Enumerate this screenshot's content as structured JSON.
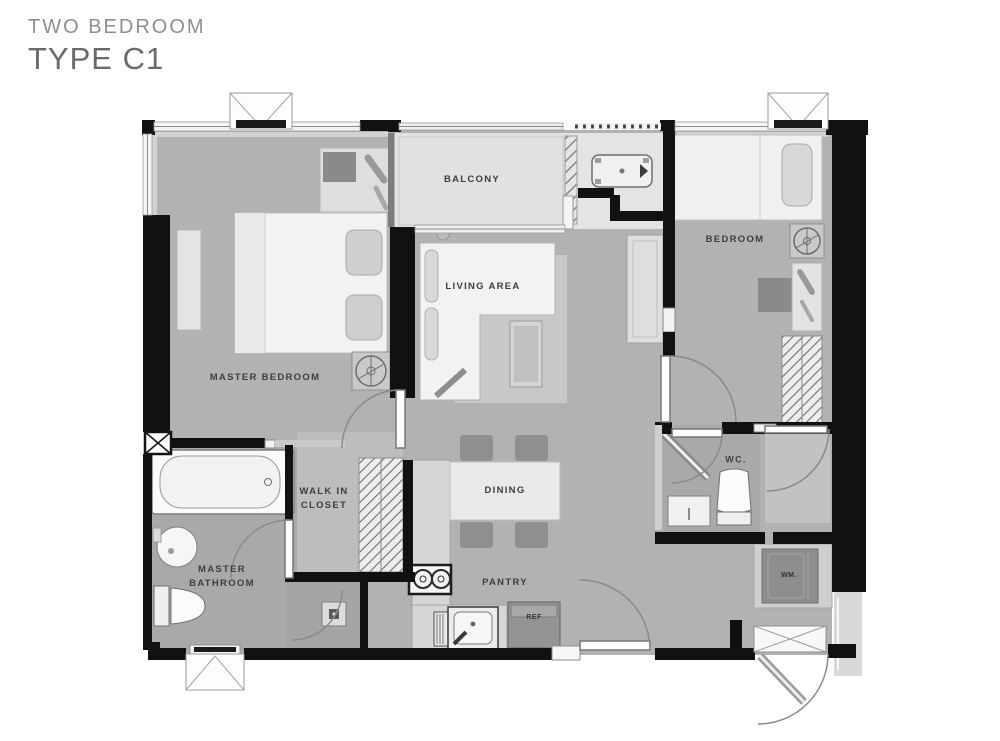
{
  "title": {
    "line1": "TWO BEDROOM",
    "line2": "TYPE C1"
  },
  "labels": {
    "master_bedroom": "MASTER BEDROOM",
    "balcony": "BALCONY",
    "living_area": "LIVING AREA",
    "bedroom": "BEDROOM",
    "walk_in_closet": "WALK IN\nCLOSET",
    "dining": "DINING",
    "master_bathroom": "MASTER\nBATHROOM",
    "wc": "WC.",
    "pantry": "PANTRY",
    "wm": "WM.",
    "ref": "REF"
  },
  "colors": {
    "wall": "#111111",
    "floor": "#b2b2b2",
    "floor_bath": "#a9a9a9",
    "floor_closet": "#bdbdbd",
    "balcony": "#e1e1e1",
    "rug": "#c8c8c8",
    "furniture_light": "#f2f2f2",
    "appliance_dark": "#8e8e8e",
    "label_text": "#3e3e3e"
  }
}
